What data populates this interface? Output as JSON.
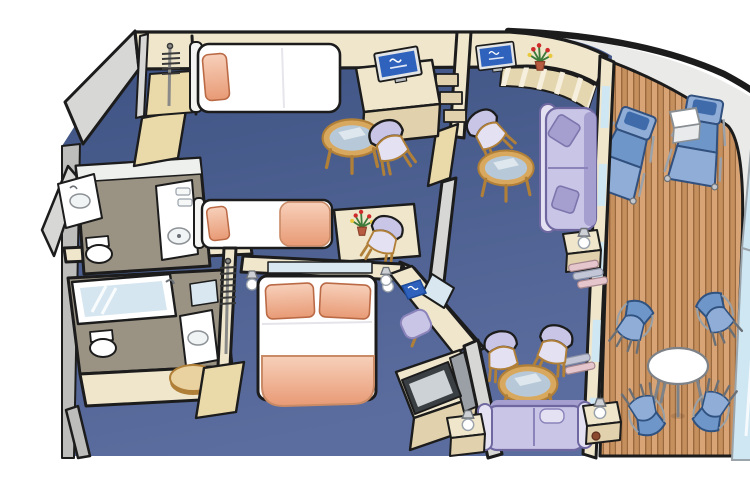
{
  "meta": {
    "description": "Isometric cutaway floor plan of a two-bedroom cruise ship family suite with two bathrooms, a living room and a large wraparound teak balcony at the ship's curved hull",
    "canvas_width": 750,
    "canvas_height": 460
  },
  "palette": {
    "background": "#ffffff",
    "outline": "#1c1c1c",
    "carpet_dark": "#3d5282",
    "carpet_light": "#5b6d9e",
    "wall_cream": "#efe6cc",
    "wall_cream_dark": "#e1d2ad",
    "door_tan": "#ead9a9",
    "wall_gray": "#d7d7d5",
    "wall_gray_dark": "#bdbdbb",
    "wood": "#d9a85f",
    "wood_dark": "#b07f38",
    "wood_light": "#ead1a0",
    "peach": "#e89a75",
    "peach_light": "#f7d0ba",
    "lavender": "#c9c5e6",
    "lavender_dark": "#a59fd0",
    "lavender_light": "#e4e1f3",
    "glass_blue": "#b7c9d8",
    "glass_light": "#d9e8f0",
    "tv_screen_blue": "#2f62bd",
    "deck_wood": "#c68f5e",
    "deck_wood_light": "#d8a476",
    "deck_seam": "#9a6a3e",
    "hull_band": "#eaeae8",
    "rail_glass": "#cfe7f3",
    "bath_floor": "#9a9384",
    "tub_water": "#d6e6f0",
    "lounger_blue": "#8fadd6",
    "lounger_blue_dark": "#6f96c8",
    "lounger_pad": "#3f6bab",
    "shelf_pink": "#e6c6cd",
    "shelf_gray": "#c3c6d6",
    "white_fixture": "#ffffff"
  },
  "rooms": [
    {
      "id": "bedroom-1",
      "label": "twin bedroom"
    },
    {
      "id": "bathroom-1",
      "label": "shower bathroom"
    },
    {
      "id": "bedroom-2",
      "label": "master bedroom"
    },
    {
      "id": "bathroom-2",
      "label": "tub bathroom"
    },
    {
      "id": "living-room",
      "label": "living room"
    },
    {
      "id": "balcony",
      "label": "wraparound teak balcony"
    }
  ],
  "furniture": {
    "bedroom_1": [
      "wardrobe-with-hangers",
      "twin-bed",
      "tv-cabinet",
      "flat-screen-tv",
      "glass-coffee-table",
      "armchair",
      "second-twin-bed",
      "writing-desk",
      "flower-vase",
      "desk-chair"
    ],
    "bathroom_1": [
      "vanity-sink",
      "toilet",
      "washstand",
      "door"
    ],
    "bedroom_2": [
      "queen-bed",
      "wall-lamps",
      "headboard-mirror",
      "vanity-desk",
      "vanity-mirror",
      "stool",
      "wardrobe-with-hangers",
      "half-round-table",
      "tv-cabinet",
      "flat-screen-tv"
    ],
    "bathroom_2": [
      "bathtub",
      "toilet",
      "sink",
      "door"
    ],
    "living_room": [
      "curved-window-desk",
      "flat-screen-tv",
      "flower-vase",
      "armchair",
      "glass-coffee-table",
      "sofa",
      "side-table-with-lamp",
      "shelf-cushions",
      "two-armchairs",
      "sofa-bed",
      "table-lamps"
    ],
    "balcony": [
      "teak-deck",
      "sun-lounger",
      "sun-lounger",
      "cube-table",
      "round-patio-table",
      "patio-chairs",
      "glass-balustrade"
    ]
  }
}
